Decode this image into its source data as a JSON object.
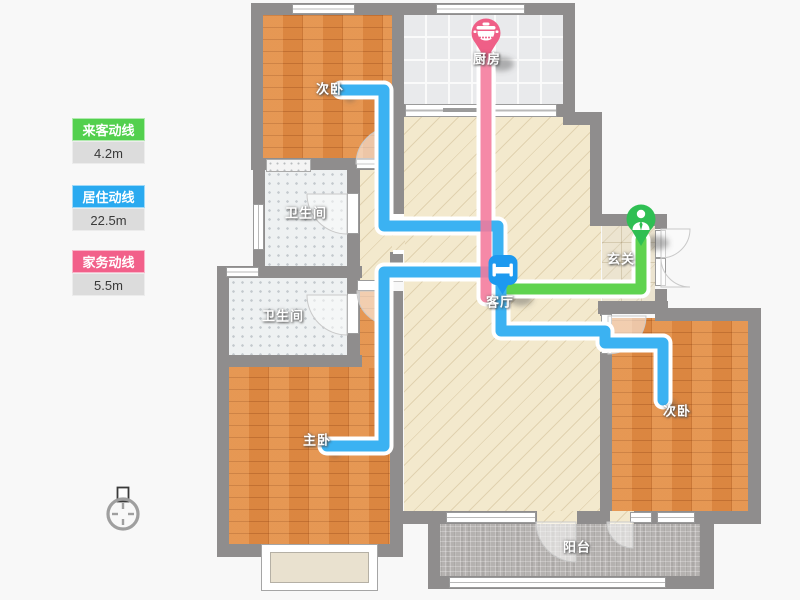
{
  "legend": {
    "items": [
      {
        "label": "来客动线",
        "value": "4.2m",
        "color": "#53d04e"
      },
      {
        "label": "居住动线",
        "value": "22.5m",
        "color": "#2aaaf0"
      },
      {
        "label": "家务动线",
        "value": "5.5m",
        "color": "#f2608a"
      }
    ]
  },
  "rooms": {
    "bedroom_top_left": {
      "label": "次卧"
    },
    "kitchen": {
      "label": "厨房"
    },
    "bathroom_upper": {
      "label": "卫生间"
    },
    "bathroom_lower": {
      "label": "卫生间"
    },
    "entry": {
      "label": "玄关"
    },
    "living": {
      "label": "客厅"
    },
    "master_bedroom": {
      "label": "主卧"
    },
    "bedroom_right": {
      "label": "次卧"
    },
    "balcony": {
      "label": "阳台"
    }
  },
  "markers": {
    "kitchen": {
      "icon": "cooking-pot-icon",
      "color": "#ef5f87"
    },
    "living": {
      "icon": "bed-icon",
      "color": "#1d99ef"
    },
    "entry": {
      "icon": "person-icon",
      "color": "#2fbf53"
    }
  },
  "lines": {
    "visitor": {
      "color": "#5fd34f"
    },
    "residence": {
      "color": "#3bb2f2"
    },
    "housework": {
      "color": "#f4799b"
    }
  },
  "colors": {
    "wall": "#8f8d8d",
    "background": "#f8f8f8"
  }
}
